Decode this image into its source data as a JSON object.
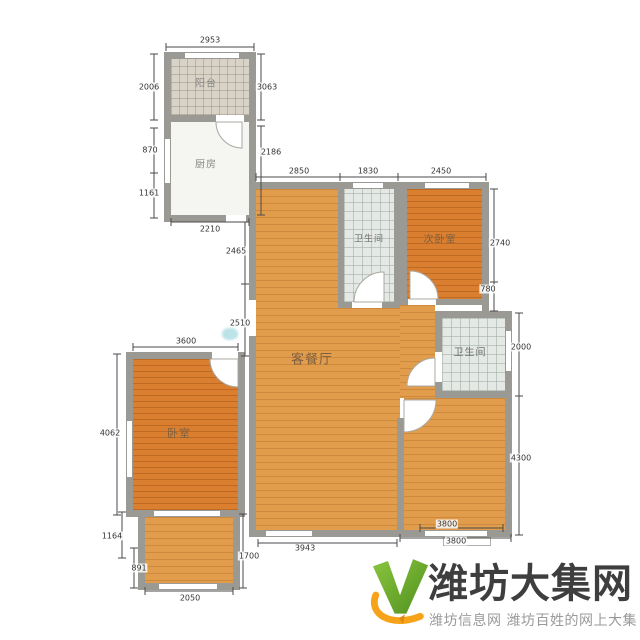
{
  "watermark": {
    "title": "潍坊大集网",
    "subtitle": "潍坊信息网 潍坊百姓的网上大集"
  },
  "palette": {
    "wall": "#9a9994",
    "plank_light": "#e29d4c",
    "plank_dark": "#da7f30",
    "tile_warm": "#d9d3c7",
    "tile_cool": "#e4e9e5",
    "dim_text": "#333333",
    "logo_green": "#72b32e",
    "logo_green_dark": "#4e8f1f",
    "logo_orange": "#f6a319",
    "title_color": "#3e3e3e",
    "subtitle_color": "#9a9a9a"
  },
  "floorplan": {
    "room_labels": [
      {
        "name": "balcony-top",
        "text": "阳台",
        "x": 206,
        "y": 82,
        "size": 10,
        "tone": "plain"
      },
      {
        "name": "kitchen",
        "text": "厨房",
        "x": 206,
        "y": 163,
        "size": 10,
        "tone": "plain"
      },
      {
        "name": "bathroom-1",
        "text": "卫生间",
        "x": 369,
        "y": 238,
        "size": 9,
        "tone": "cool"
      },
      {
        "name": "bedroom-2",
        "text": "次卧室",
        "x": 440,
        "y": 238,
        "size": 10,
        "tone": "warm"
      },
      {
        "name": "living-dining",
        "text": "客餐厅",
        "x": 312,
        "y": 358,
        "size": 13,
        "tone": "warm"
      },
      {
        "name": "bathroom-2",
        "text": "卫生间",
        "x": 470,
        "y": 351,
        "size": 10,
        "tone": "cool"
      },
      {
        "name": "bedroom-1",
        "text": "卧室",
        "x": 179,
        "y": 433,
        "size": 11,
        "tone": "warm"
      }
    ],
    "dimensions": [
      {
        "text": "2953",
        "x": 210,
        "y": 40,
        "line": [
          166,
          47,
          254,
          47
        ]
      },
      {
        "text": "2006",
        "x": 149,
        "y": 87,
        "line": [
          154,
          54,
          154,
          120
        ]
      },
      {
        "text": "3063",
        "x": 267,
        "y": 87,
        "line": [
          261,
          54,
          261,
          120
        ]
      },
      {
        "text": "870",
        "x": 150,
        "y": 150,
        "line": [
          154,
          128,
          154,
          173
        ]
      },
      {
        "text": "1161",
        "x": 149,
        "y": 193,
        "line": [
          154,
          173,
          154,
          218
        ]
      },
      {
        "text": "2186",
        "x": 271,
        "y": 152,
        "line": [
          261,
          126,
          261,
          215
        ]
      },
      {
        "text": "2210",
        "x": 210,
        "y": 229,
        "line": [
          171,
          222,
          249,
          222
        ]
      },
      {
        "text": "2850",
        "x": 299,
        "y": 171,
        "line": [
          256,
          177,
          340,
          177
        ]
      },
      {
        "text": "1830",
        "x": 368,
        "y": 171,
        "line": [
          340,
          177,
          398,
          177
        ]
      },
      {
        "text": "2450",
        "x": 441,
        "y": 171,
        "line": [
          398,
          177,
          486,
          177
        ]
      },
      {
        "text": "2465",
        "x": 236,
        "y": 251,
        "line": [
          245,
          222,
          245,
          284
        ]
      },
      {
        "text": "2510",
        "x": 240,
        "y": 323,
        "line": [
          245,
          284,
          245,
          356
        ]
      },
      {
        "text": "2740",
        "x": 500,
        "y": 243,
        "line": [
          494,
          189,
          494,
          282
        ]
      },
      {
        "text": "780",
        "x": 488,
        "y": 289,
        "line": [
          494,
          282,
          494,
          311
        ]
      },
      {
        "text": "2000",
        "x": 521,
        "y": 347,
        "line": [
          519,
          313,
          519,
          396
        ]
      },
      {
        "text": "4300",
        "x": 521,
        "y": 458,
        "line": [
          519,
          396,
          519,
          535
        ]
      },
      {
        "text": "3600",
        "x": 186,
        "y": 341,
        "line": [
          133,
          347,
          238,
          347
        ]
      },
      {
        "text": "4062",
        "x": 110,
        "y": 433,
        "line": [
          117,
          354,
          117,
          515
        ]
      },
      {
        "text": "1164",
        "x": 112,
        "y": 536,
        "line": [
          122,
          512,
          122,
          558
        ]
      },
      {
        "text": "891",
        "x": 139,
        "y": 568,
        "line": [
          134,
          548,
          134,
          588
        ]
      },
      {
        "text": "2050",
        "x": 190,
        "y": 598,
        "line": [
          145,
          591,
          233,
          591
        ]
      },
      {
        "text": "1700",
        "x": 249,
        "y": 556,
        "line": [
          243,
          514,
          243,
          588
        ]
      },
      {
        "text": "3943",
        "x": 305,
        "y": 548,
        "line": [
          258,
          543,
          397,
          543
        ]
      },
      {
        "text": "3800",
        "x": 447,
        "y": 524,
        "line": [
          420,
          528,
          503,
          528
        ]
      },
      {
        "text": "3800",
        "x": 456,
        "y": 541,
        "line": [
          400,
          538,
          511,
          538
        ]
      }
    ]
  }
}
